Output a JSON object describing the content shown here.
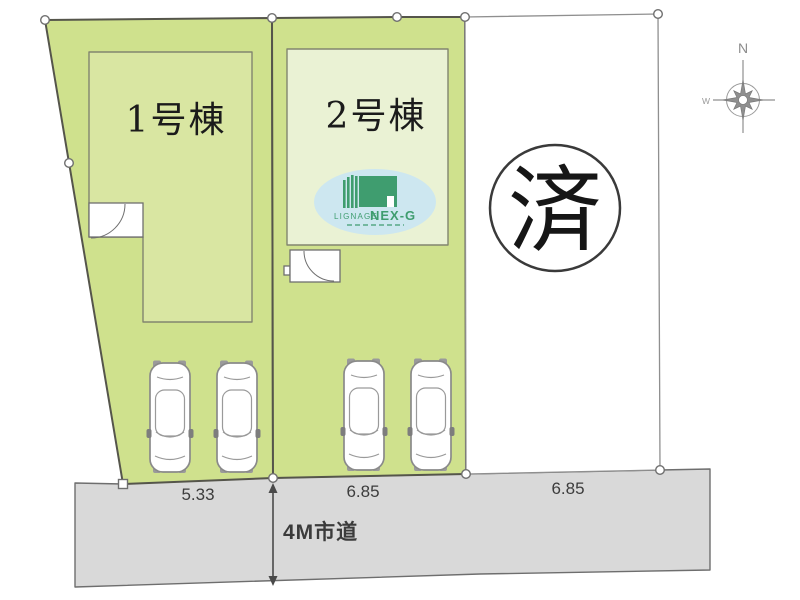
{
  "plan": {
    "lot1_name": "1号棟",
    "lot2_name": "2号棟",
    "lot3_status": "済",
    "lot1_frontage": "5.33",
    "lot2_frontage": "6.85",
    "lot3_frontage": "6.85",
    "road_label": "4M市道"
  },
  "compass": {
    "north": "N",
    "west": "W"
  },
  "logo": {
    "brand_prefix": "LIGNAGE",
    "brand_name": "NEX-G"
  },
  "colors": {
    "lot_green": "#cfe18d",
    "building1_fill": "#d9e6a2",
    "building2_fill": "#eaf2d4",
    "road_gray": "#d9d9d9",
    "logo_blue": "#cde7f0",
    "logo_green": "#3f9d6f"
  }
}
